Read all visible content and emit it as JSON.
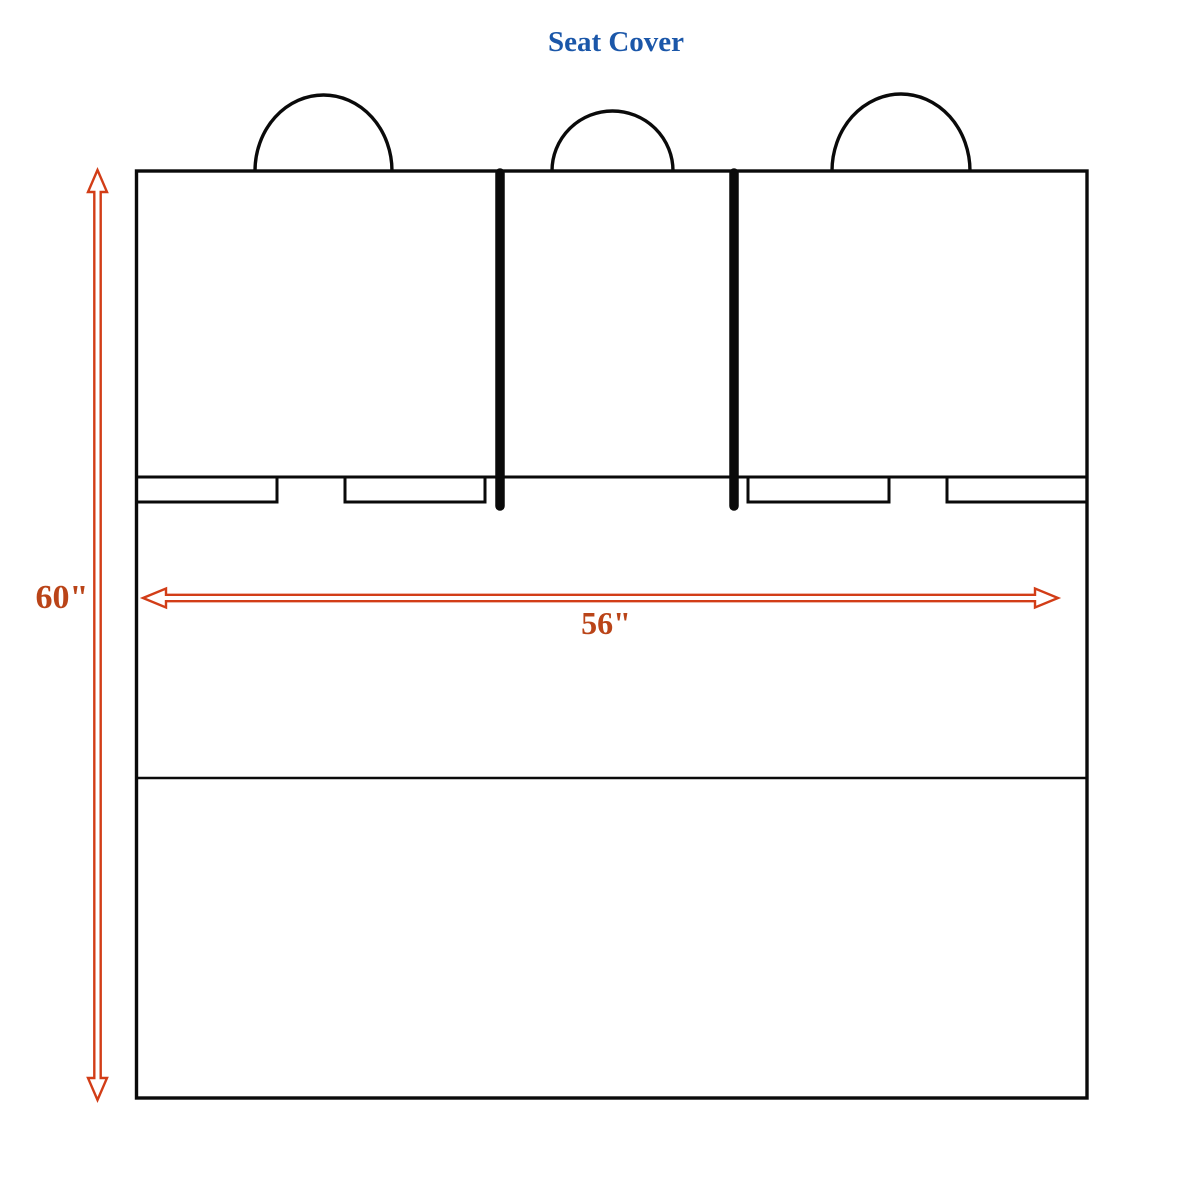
{
  "title": "Seat Cover",
  "dimensions": {
    "height_label": "60\"",
    "width_label": "56\""
  },
  "colors": {
    "title_blue": "#1B57A9",
    "accent_red": "#D23D17",
    "label_red": "#BA4418",
    "line_black": "#0A0A0A",
    "background": "#FFFFFF"
  }
}
